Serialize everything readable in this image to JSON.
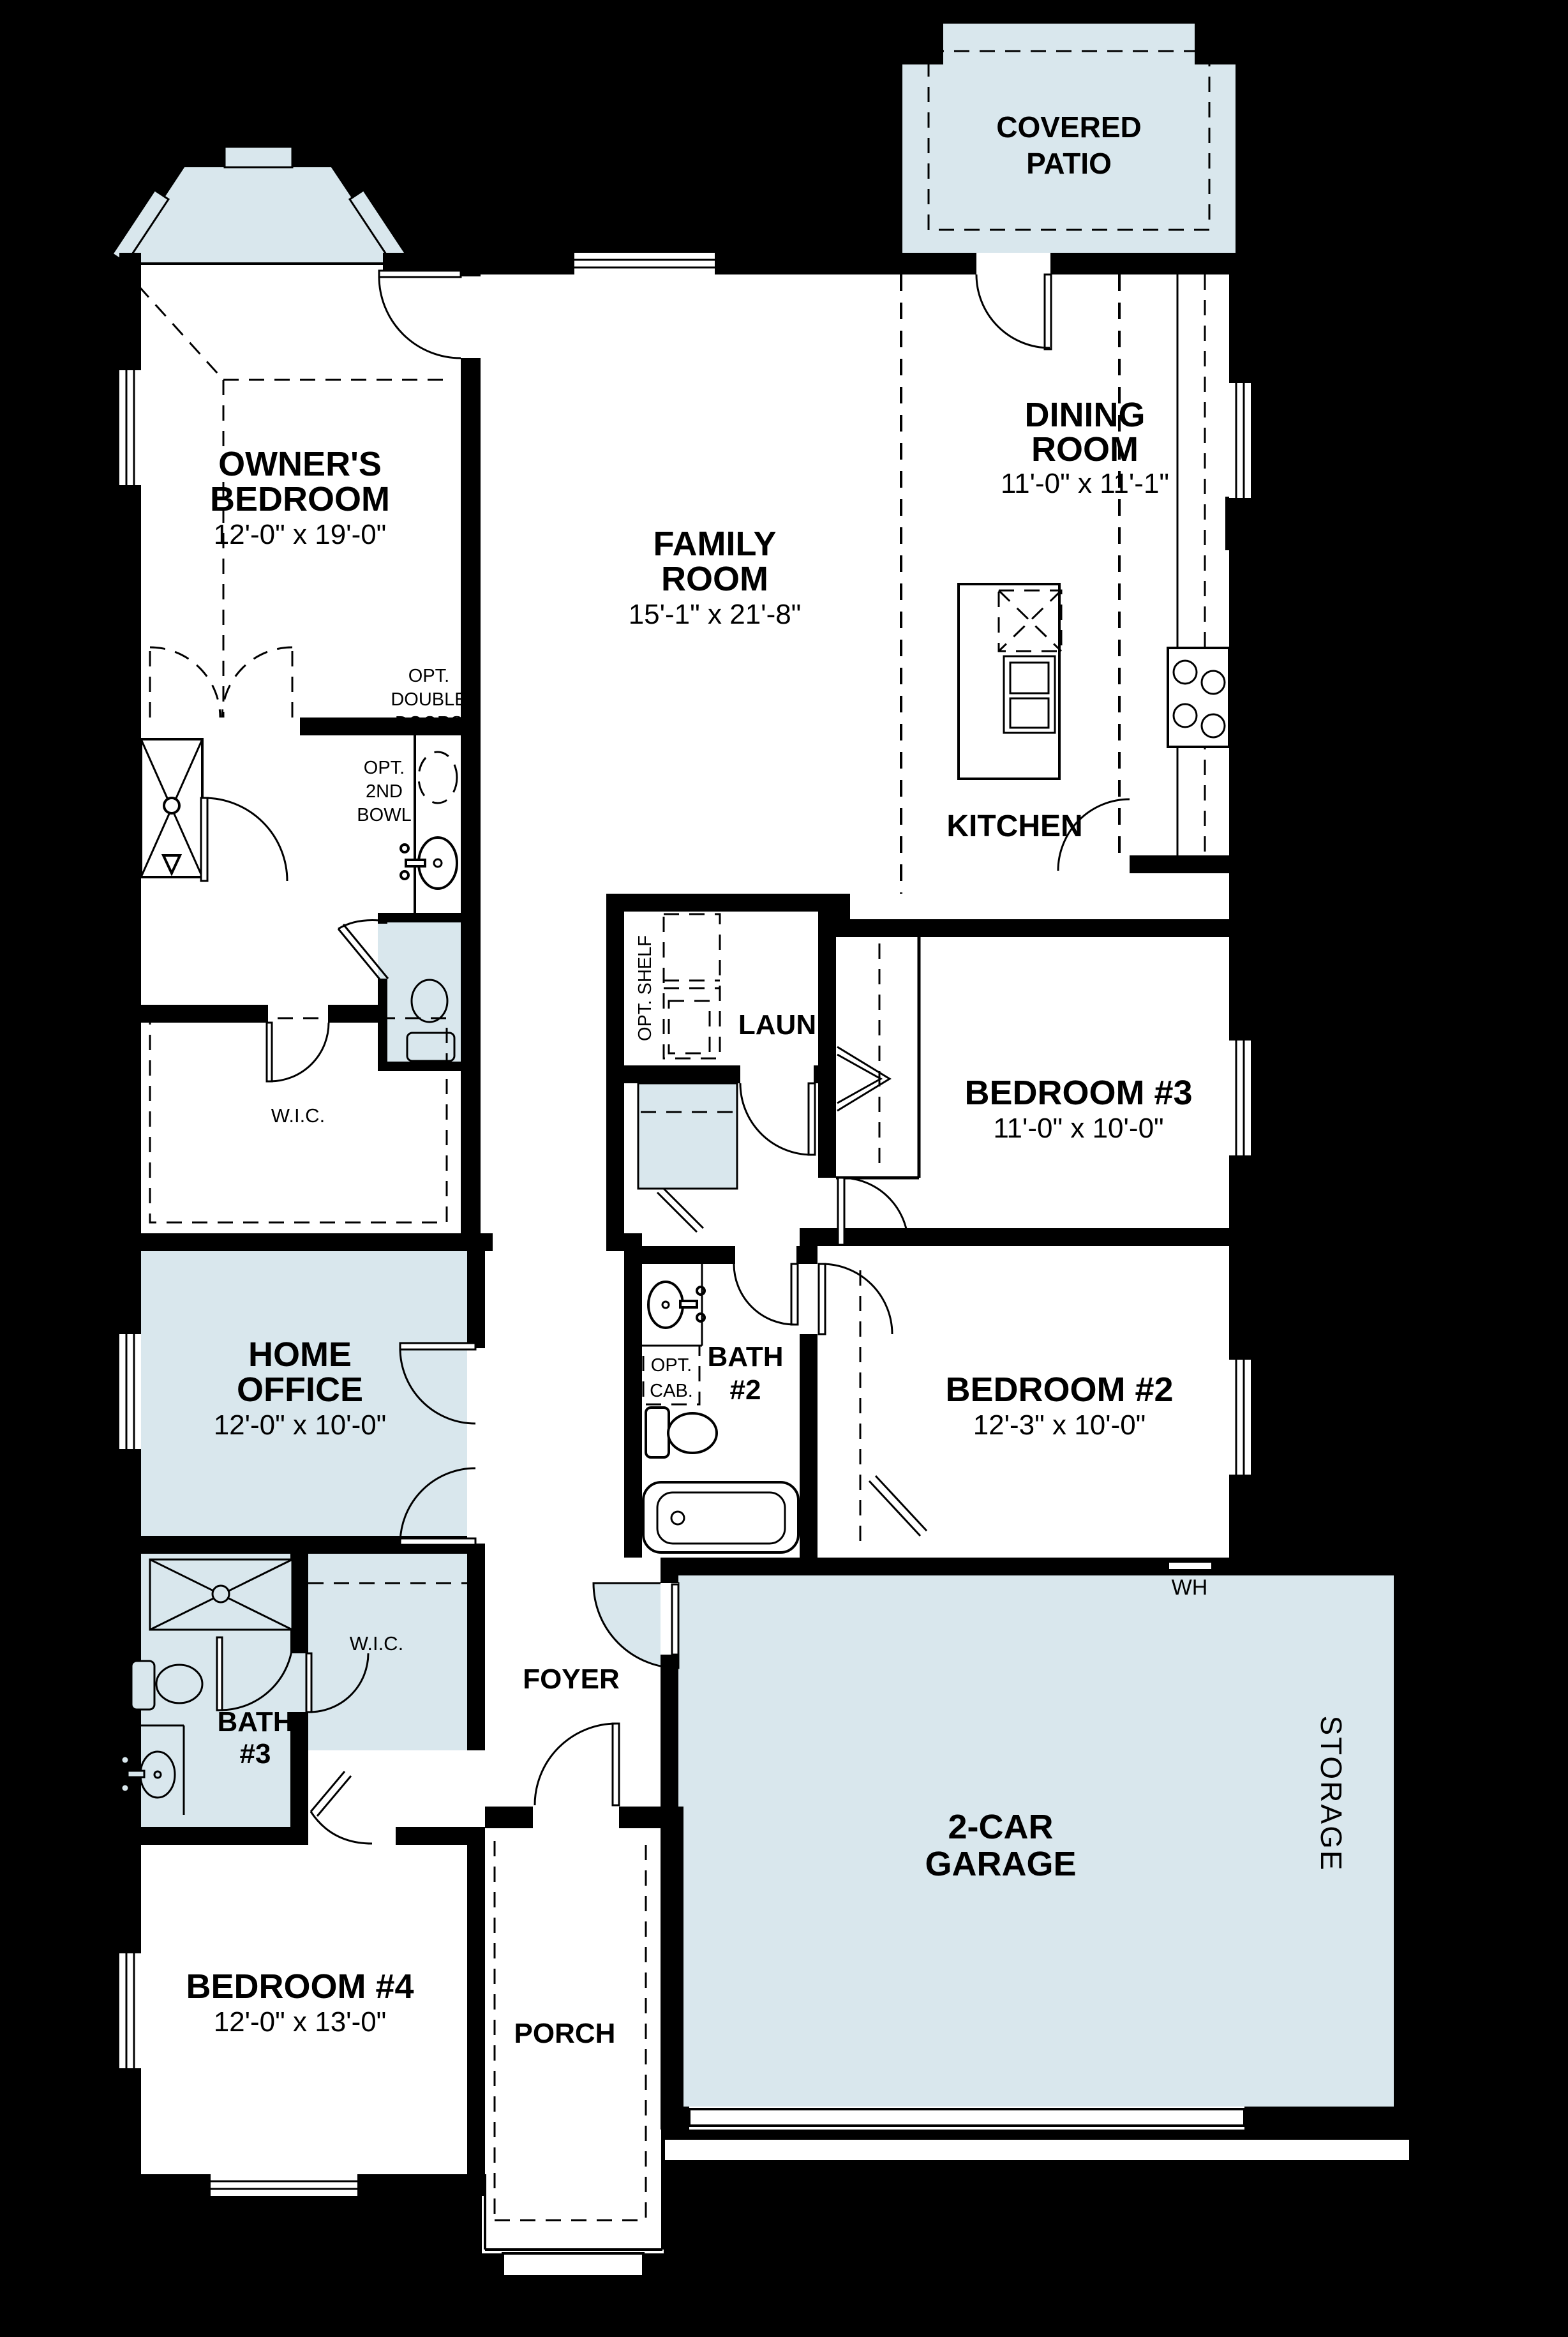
{
  "colors": {
    "background": "#000000",
    "floor": "#ffffff",
    "accent_room_fill": "#d9e7ed",
    "wall": "#000000",
    "text": "#000000"
  },
  "rooms": {
    "covered_patio": {
      "line1": "COVERED",
      "line2": "PATIO"
    },
    "owners_bedroom": {
      "line1": "OWNER'S",
      "line2": "BEDROOM",
      "dims": "12'-0\" x 19'-0\""
    },
    "family_room": {
      "line1": "FAMILY",
      "line2": "ROOM",
      "dims": "15'-1\" x 21'-8\""
    },
    "dining_room": {
      "line1": "DINING",
      "line2": "ROOM",
      "dims": "11'-0\" x 11'-1\""
    },
    "kitchen": {
      "label": "KITCHEN"
    },
    "laundry": {
      "label": "LAUN"
    },
    "bedroom3": {
      "label": "BEDROOM #3",
      "dims": "11'-0\" x 10'-0\""
    },
    "bedroom2": {
      "label": "BEDROOM #2",
      "dims": "12'-3\" x 10'-0\""
    },
    "bedroom4": {
      "label": "BEDROOM #4",
      "dims": "12'-0\" x 13'-0\""
    },
    "home_office": {
      "line1": "HOME",
      "line2": "OFFICE",
      "dims": "12'-0\" x 10'-0\""
    },
    "bath2": {
      "line1": "BATH",
      "line2": "#2"
    },
    "bath3": {
      "line1": "BATH",
      "line2": "#3"
    },
    "wic_owner": {
      "label": "W.I.C."
    },
    "wic_bed4": {
      "label": "W.I.C."
    },
    "foyer": {
      "label": "FOYER"
    },
    "porch": {
      "label": "PORCH"
    },
    "garage": {
      "line1": "2-CAR",
      "line2": "GARAGE"
    },
    "storage": {
      "label": "STORAGE"
    },
    "water_heater": {
      "label": "WH"
    }
  },
  "annotations": {
    "opt_double_doors": {
      "line1": "OPT.",
      "line2": "DOUBLE",
      "line3": "DOORS"
    },
    "opt_2nd_bowl": {
      "line1": "OPT.",
      "line2": "2ND",
      "line3": "BOWL"
    },
    "opt_cab": {
      "line1": "OPT.",
      "line2": "CAB."
    },
    "opt_shelf": {
      "label": "OPT. SHELF"
    }
  }
}
